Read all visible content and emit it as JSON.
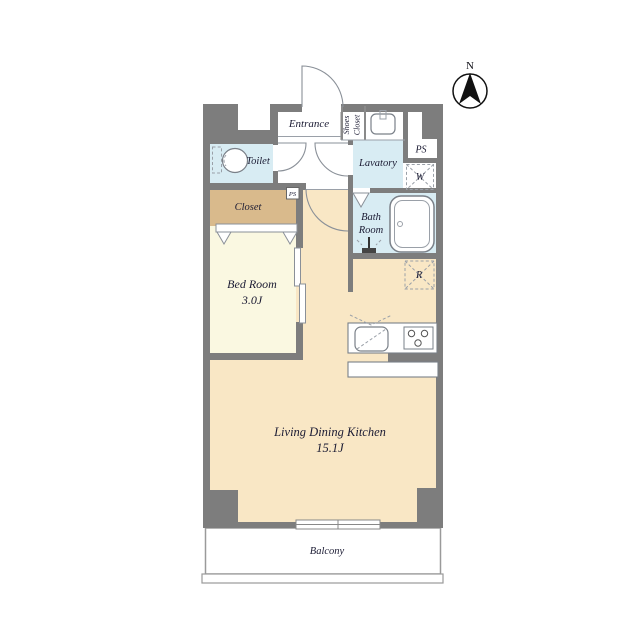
{
  "meta": {
    "type": "apartment-floor-plan"
  },
  "colors": {
    "wall": "#7d7d7d",
    "wet_room": "#d8ecf3",
    "closet": "#d9ba8c",
    "bedroom": "#faf8e1",
    "ldk": "#f9e7c5",
    "floor_white": "#ffffff",
    "line": "#8a9098",
    "text": "#1b1b33"
  },
  "compass": {
    "north_label": "N"
  },
  "rooms": {
    "entrance": {
      "label": "Entrance"
    },
    "shoes_closet": {
      "word1": "Shoes",
      "word2": "Closet"
    },
    "toilet": {
      "label": "Toilet"
    },
    "lavatory": {
      "label": "Lavatory"
    },
    "bath_room": {
      "word1": "Bath",
      "word2": "Room"
    },
    "closet": {
      "label": "Closet"
    },
    "bed_room": {
      "name": "Bed Room",
      "size": "3.0J"
    },
    "ldk": {
      "name": "Living Dining Kitchen",
      "size": "15.1J"
    },
    "balcony": {
      "label": "Balcony"
    }
  },
  "utility_labels": {
    "pipe_space_top": "PS",
    "pipe_space_small": "PS",
    "washing_machine": "W",
    "refrigerator": "R"
  }
}
